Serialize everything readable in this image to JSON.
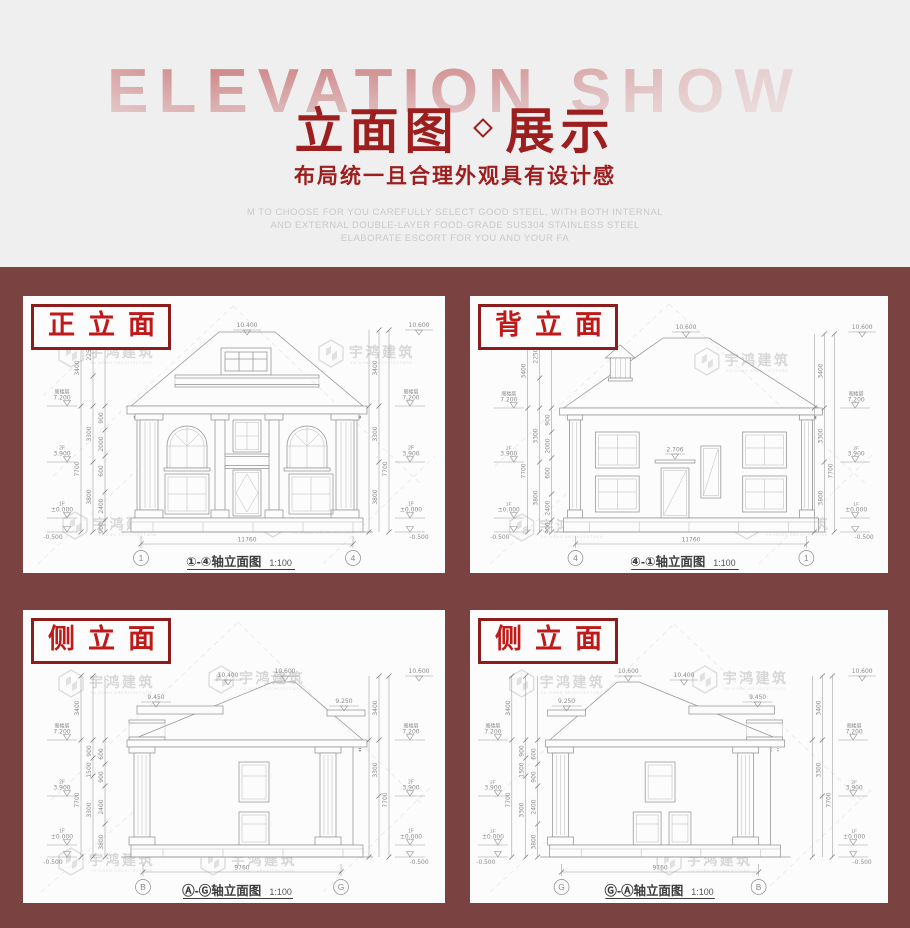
{
  "colors": {
    "header_bg": "#f0eff0",
    "maroon_bg": "#7b4242",
    "title_red": "#9d1e1e",
    "label_red": "#c01919",
    "label_border": "#8e1c1c",
    "fade_red": "#ba4b4b"
  },
  "header": {
    "bg_text": "ELEVATION SHOW",
    "title_left": "立面图",
    "title_right": "展示",
    "subtitle": "布局统一且合理外观具有设计感",
    "desc_lines": [
      "M TO CHOOSE FOR YOU CAREFULLY SELECT GOOD STEEL, WITH BOTH INTERNAL",
      "AND EXTERNAL DOUBLE-LAYER FOOD-GRADE SUS304 STAINLESS STEEL",
      "ELABORATE ESCORT FOR YOU AND YOUR FA"
    ]
  },
  "watermark": {
    "name": "宇鸿建筑",
    "sub": "YU HONG ARCHITECTURE"
  },
  "levels": {
    "attic_name": "阁楼层",
    "attic": "7.200",
    "f2_name": "2F",
    "f2": "3.900",
    "f1_name": "1F",
    "f1": "±0.000",
    "base": "-0.500"
  },
  "panels": [
    {
      "label": "正立面",
      "caption": "①-④轴立面图",
      "scale": "1:100",
      "axis": {
        "left": "1",
        "right": "4"
      },
      "width_dim": "11760",
      "top": {
        "apex": "10.400",
        "right": "10.600"
      },
      "outer": [
        "3400",
        "7700"
      ],
      "mid": [
        "2250",
        "3300",
        "3800"
      ],
      "inner": [
        "900",
        "2000",
        "600",
        "2400",
        "900"
      ]
    },
    {
      "label": "背立面",
      "caption": "④-①轴立面图",
      "scale": "1:100",
      "axis": {
        "left": "4",
        "right": "1"
      },
      "width_dim": "11760",
      "door_dim": "2.706",
      "top": {
        "apex": "10.600",
        "right": "10.600"
      },
      "outer": [
        "3400",
        "7700"
      ],
      "mid": [
        "2250",
        "3300",
        "3800"
      ],
      "inner": [
        "900",
        "2000",
        "600",
        "2400",
        "900"
      ]
    },
    {
      "label": "侧立面",
      "caption": "Ⓐ-Ⓖ轴立面图",
      "scale": "1:100",
      "axis": {
        "left": "B",
        "right": "G"
      },
      "width_dim": "9760",
      "top": {
        "apex": "10.600",
        "mid": "10.400",
        "left_low": "9.450",
        "right_low": "9.250",
        "right": "10.600"
      },
      "outer": [
        "3400",
        "7700"
      ],
      "mid": [
        "900",
        "1500",
        "3300"
      ],
      "inner": [
        "600",
        "900",
        "2400",
        "3800"
      ]
    },
    {
      "label": "侧立面",
      "caption": "Ⓖ-Ⓐ轴立面图",
      "scale": "1:100",
      "axis": {
        "left": "G",
        "right": "B"
      },
      "width_dim": "9760",
      "top": {
        "apex": "10.600",
        "mid": "10.400",
        "left_low": "9.250",
        "right_low": "9.450",
        "right": "10.600"
      },
      "outer": [
        "3400",
        "7700"
      ],
      "mid": [
        "900",
        "1500",
        "3300"
      ],
      "inner": [
        "600",
        "900",
        "2400",
        "3800"
      ]
    }
  ]
}
